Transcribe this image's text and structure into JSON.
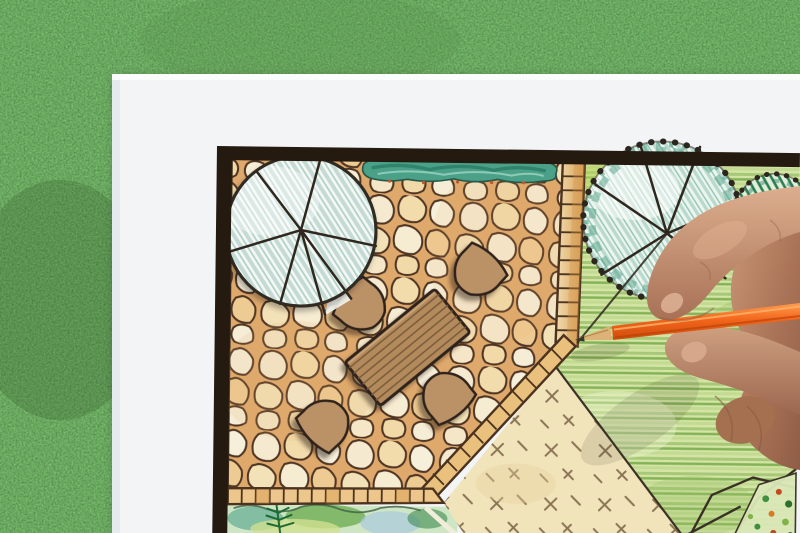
{
  "scene": {
    "type": "photograph",
    "description": "Overhead close-up of a hand drawing a colored landscape garden design plan with an orange pencil on a white sheet of paper that lies on green grass",
    "background": {
      "label": "green grass lawn",
      "base_color": "#47713a"
    },
    "paper": {
      "label": "white drawing paper sheet",
      "color": "#f2f4f6"
    },
    "plan": {
      "label": "hand-drawn garden plan",
      "border_color": "#241a10",
      "areas": [
        {
          "name": "flagstone-patio",
          "label": "irregular flagstone paving",
          "stone_color": "#f4e8cc",
          "grout_color": "#dfa96c",
          "line_color": "#4e3423"
        },
        {
          "name": "lawn-area",
          "label": "groundcover lawn with cross hatch marks",
          "color": "#f1e4bb",
          "mark_color": "#8a7454"
        },
        {
          "name": "garden-bed-right",
          "label": "green planted garden area, colored pencil hatching",
          "color": "#d4e4a4"
        },
        {
          "name": "plant-bed-bottom",
          "label": "watercolor shrub border bed",
          "colors": [
            "#7ab89e",
            "#6fae55",
            "#a9c9de",
            "#cfe08e"
          ]
        },
        {
          "name": "hedge-strip",
          "label": "teal hedge row at patio top",
          "color": "#4aa188"
        },
        {
          "name": "flower-bed-corner",
          "label": "flower bed with red and green dots",
          "colors": [
            "#3f8f3f",
            "#c2481f",
            "#d97a24"
          ]
        }
      ],
      "symbols": [
        {
          "name": "tree-symbol-left",
          "label": "large round tree / parasol symbol with radial ribs over patio",
          "fill": "#f4f7f3",
          "hatch": "#c4dbd5"
        },
        {
          "name": "tree-symbol-right",
          "label": "scallop-edged tree symbol with spokes",
          "fill": "#edf5ef",
          "scribble": "#4f9f86"
        },
        {
          "name": "shrub-symbol",
          "label": "scallop-edged shrub with dark green hatching",
          "hatch": "#2f7d4c"
        },
        {
          "name": "dining-table",
          "label": "rectangular wooden plank table, plan view",
          "color": "#b28a5c"
        },
        {
          "name": "chairs",
          "label": "four fan-back chairs around table",
          "count": 4,
          "color": "#bb9166"
        },
        {
          "name": "tile-borders",
          "label": "small square tile edging strips",
          "color": "#e9c07c"
        }
      ]
    },
    "hand": {
      "label": "right hand holding pencil, entering from right edge",
      "skin_tones": [
        "#cfa081",
        "#b5846a",
        "#8f5d46"
      ]
    },
    "pencil": {
      "label": "orange colored pencil, sharpened tip touching plan",
      "body_color": "#f2661c",
      "wood_color": "#dcb277",
      "lead_color": "#3a342e"
    }
  }
}
